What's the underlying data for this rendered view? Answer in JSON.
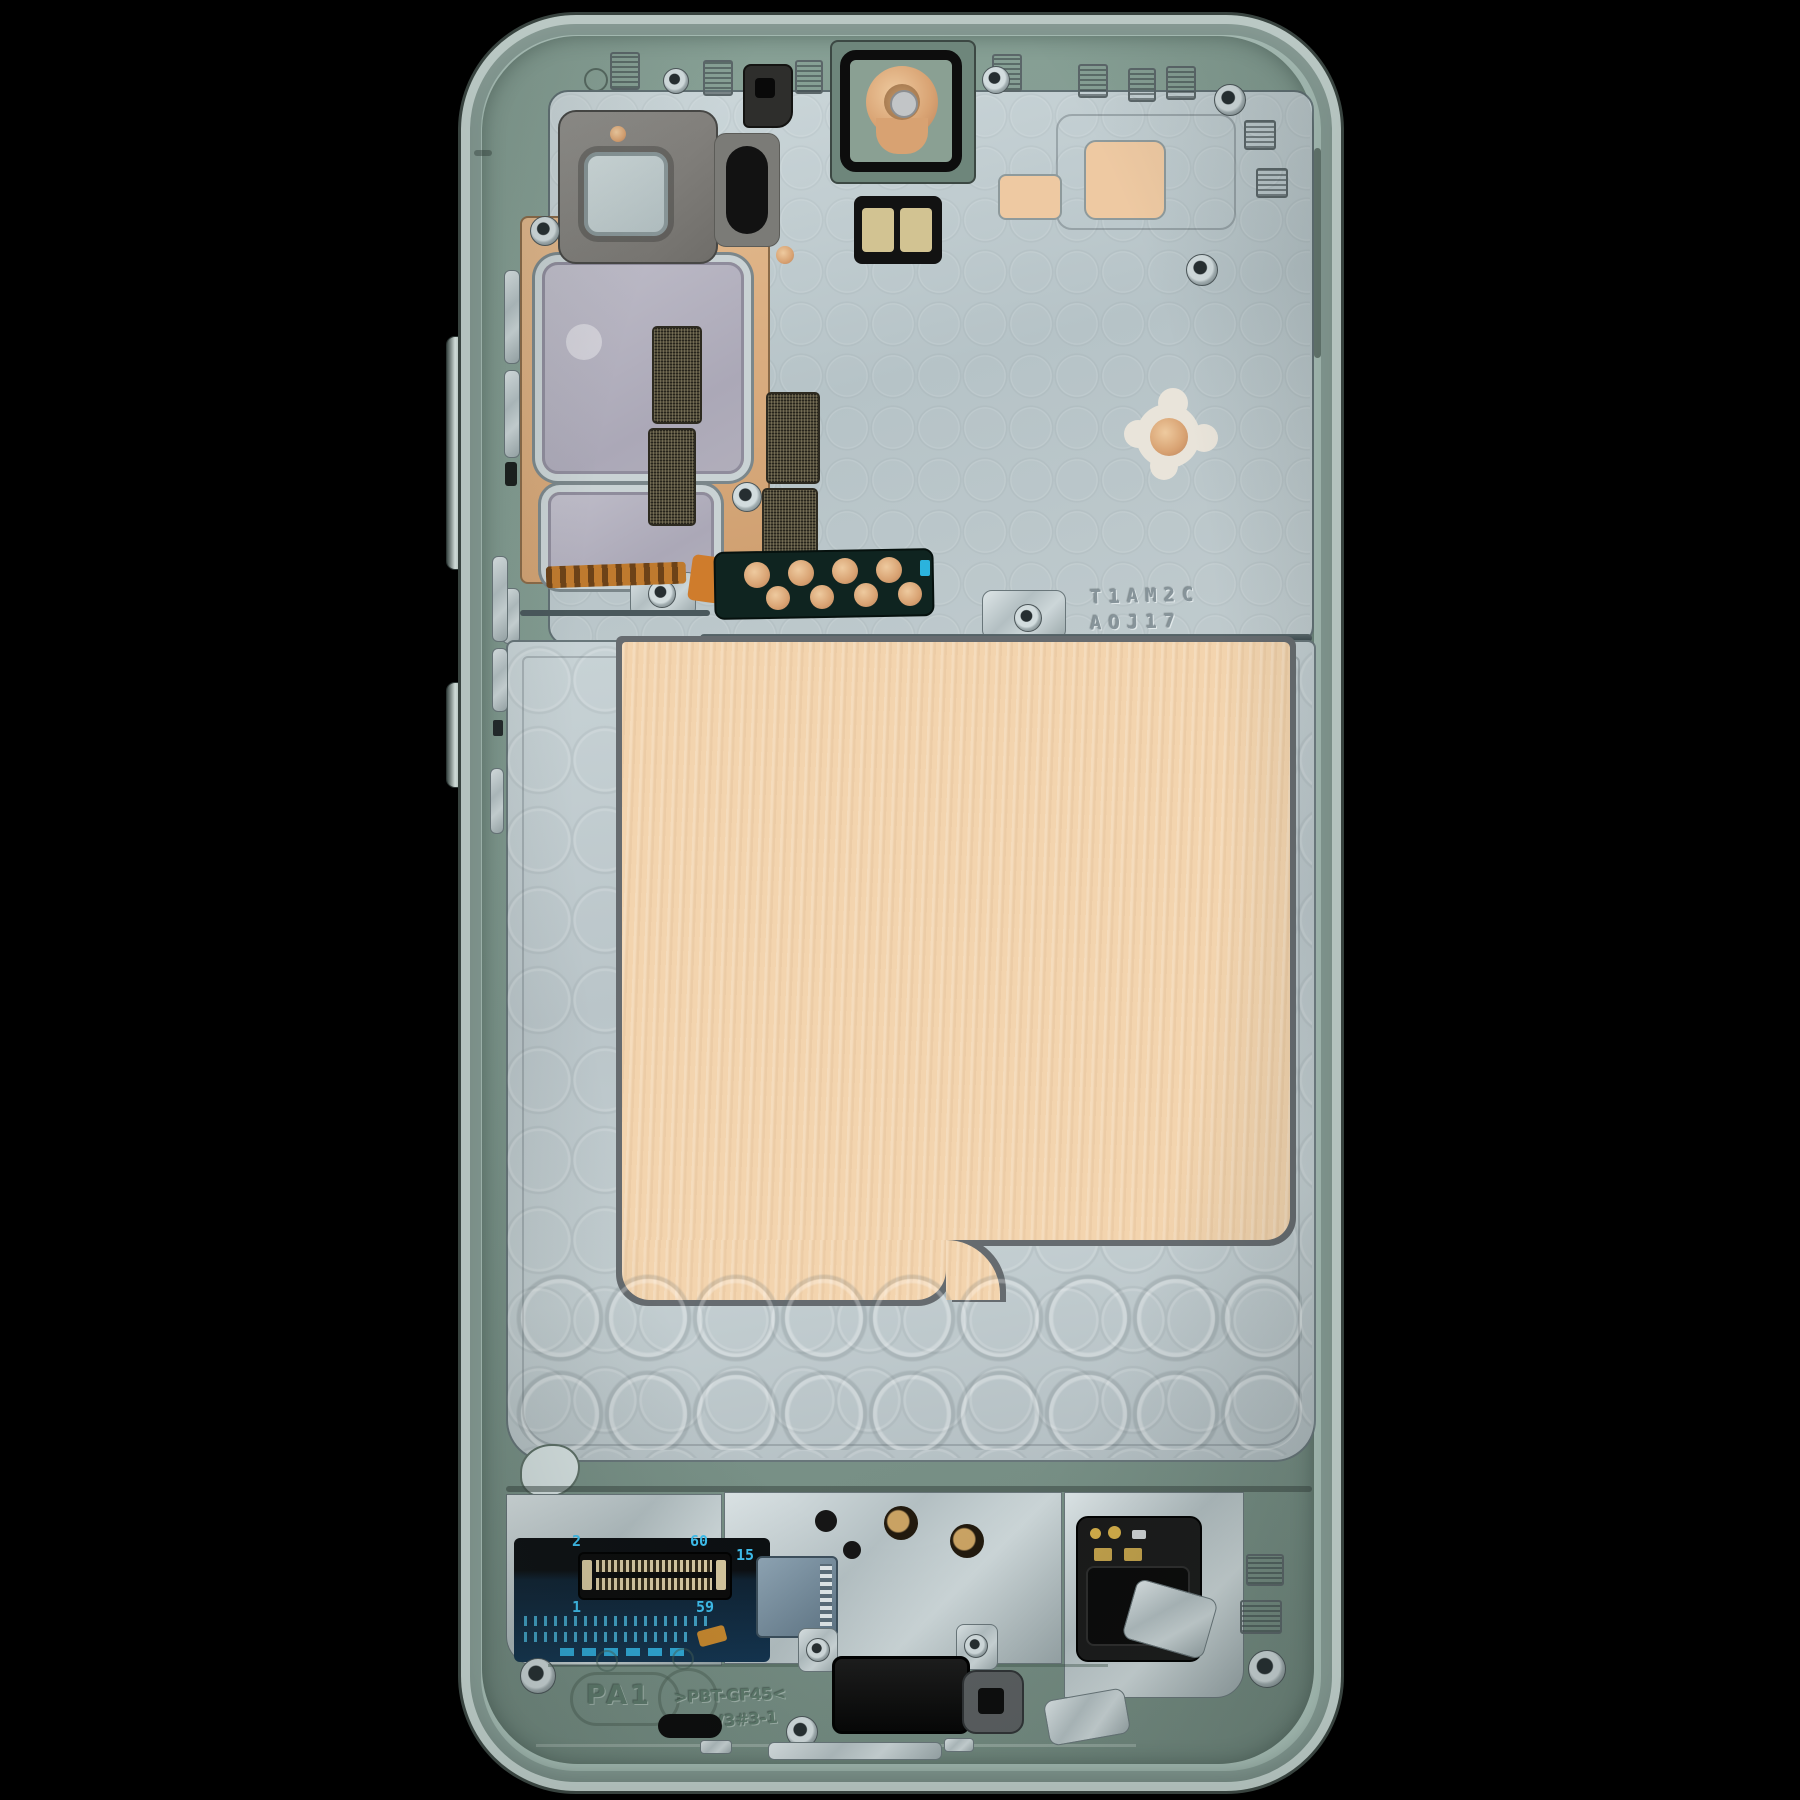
{
  "labels": {
    "stamp_line1": "T1AM2C",
    "stamp_line2": "AOJ17",
    "pin_top_left": "2",
    "pin_top_right": "60",
    "pin_bottom_left": "1",
    "pin_bottom_right": "59",
    "pin_aux": "15",
    "mold_part": "PA1",
    "mold_material": ">PBT-GF45<",
    "mold_version": "V3#3-1"
  },
  "colors": {
    "background": "#000000",
    "frame_green": "#859c92",
    "rail_silver": "#c6d2ce",
    "plate_silver": "#c2cdd1",
    "thermal_pad_tan": "#f3d4ae",
    "shield_pad_gray": "#b3b1bc",
    "copper": "#dcae80",
    "pcb_blue": "#16344a",
    "silkscreen_cyan": "#3ec0f0",
    "module_black": "#141414"
  }
}
